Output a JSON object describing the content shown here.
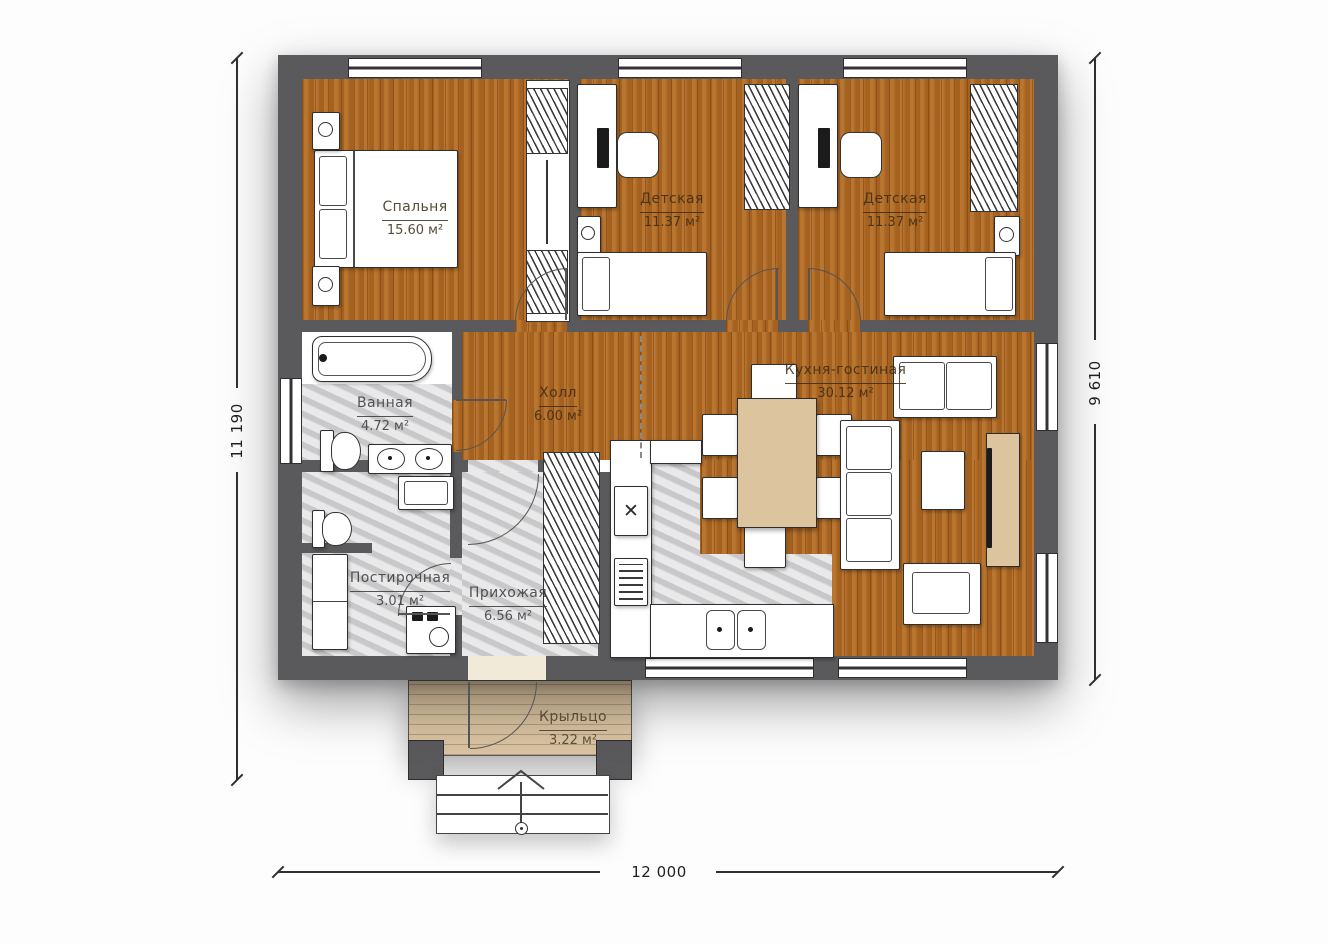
{
  "plan": {
    "rooms": [
      {
        "id": "bedroom",
        "name": "Спальня",
        "area": "15.60 м²"
      },
      {
        "id": "kids1",
        "name": "Детская",
        "area": "11.37 м²"
      },
      {
        "id": "kids2",
        "name": "Детская",
        "area": "11.37 м²"
      },
      {
        "id": "bathroom",
        "name": "Ванная",
        "area": "4.72 м²"
      },
      {
        "id": "hall",
        "name": "Холл",
        "area": "6.00 м²"
      },
      {
        "id": "kitchen_living",
        "name": "Кухня-гостиная",
        "area": "30.12 м²"
      },
      {
        "id": "laundry",
        "name": "Постирочная",
        "area": "3.01 м²"
      },
      {
        "id": "entry",
        "name": "Прихожая",
        "area": "6.56 м²"
      },
      {
        "id": "porch",
        "name": "Крыльцо",
        "area": "3.22 м²"
      }
    ],
    "dimensions": {
      "left": "11 190",
      "right": "9 610",
      "bottom": "12 000"
    },
    "icons": {
      "stove": "✕"
    },
    "colors": {
      "wall": "#5a5a5c",
      "wood": "#ad6824",
      "tile": "#d7d7d9",
      "porch_wood": "#d9c3a2",
      "accent_tan": "#dcc59e"
    }
  }
}
